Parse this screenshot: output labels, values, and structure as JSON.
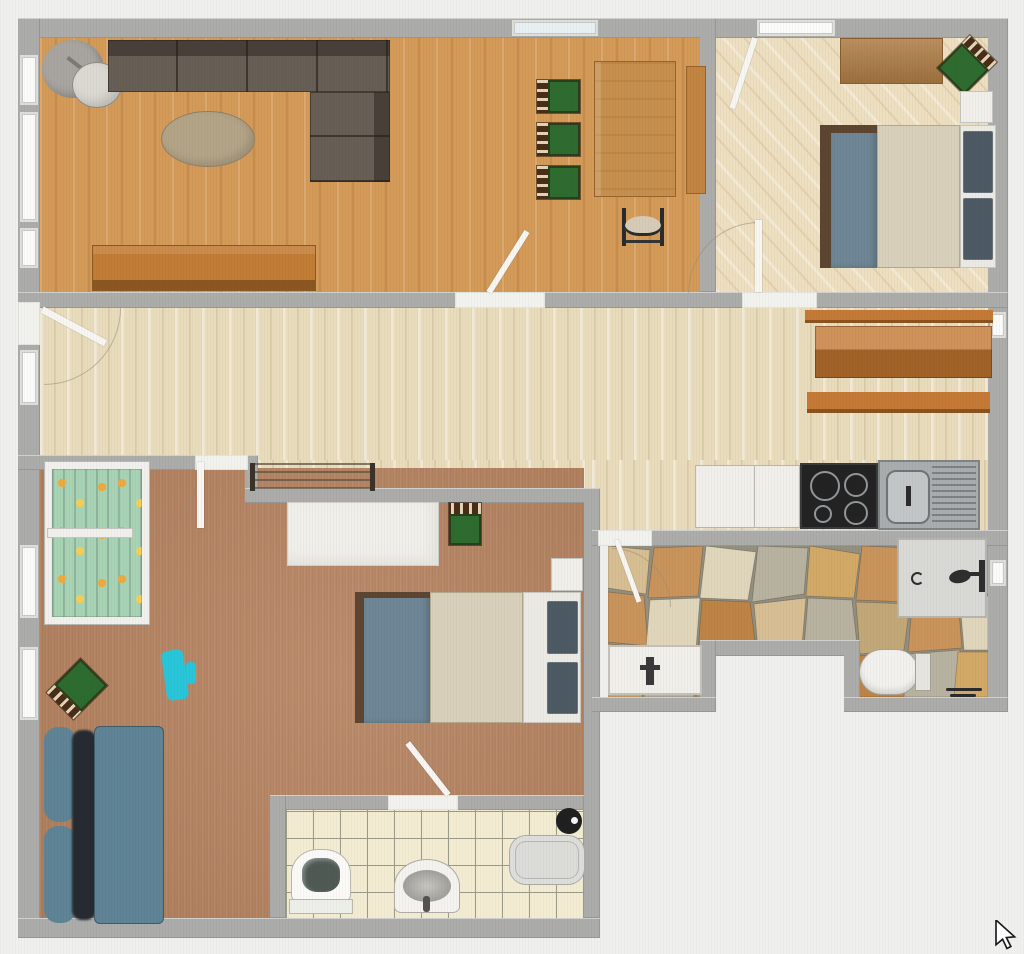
{
  "view": {
    "type": "floor-plan-2d-top-view",
    "cursor_glyph": "arrow-pointer"
  },
  "palette": {
    "wall": "#ACACAA",
    "threshold": "#F2F2EF",
    "window": "#FBFBFA",
    "outside": "#F0F0EE",
    "floor_living": "#D49A58",
    "floor_bedroom": "#EDDFC0",
    "floor_hall": "#E9DCBC",
    "floor_kids": "#B5825F",
    "floor_tile": "#F3ECD2",
    "grout_stone": "#93907F",
    "sofa_dark": "#675E55",
    "sofa_dark_back": "#4E463F",
    "sofa_teal": "#5E8495",
    "sofa_teal_shadow": "#252B31",
    "coffee_table": "#B4A487",
    "sideboard": "#C17C35",
    "dining_table": "#C68F4E",
    "bench": "#C28441",
    "plank": "#C47A36",
    "chair_green": "#2E6B2F",
    "chair_frame": "#4A2D17",
    "chair_dark_seat": "#D6CBB6",
    "wardrobe": "#B08049",
    "bed_frame": "#5C4632",
    "bed_blanket": "#6E8695",
    "bed_mattress": "#D9D0BC",
    "bed_head": "#ECEAE5",
    "bed_pillow": "#4D5A64",
    "white_furniture": "#F0EFEA",
    "crib_blanket": "#A8D3B4",
    "toy": "#29C5D8",
    "radiator": "#5F5544",
    "cooktop": "#232323",
    "steel": "#A9ADAE",
    "shower": "#D9D9D5",
    "tub": "#DCDCD8",
    "fixture_dark": "#202020",
    "lamp_base": "#A8A5A0",
    "lamp_shade": "#DCD8D2"
  },
  "rooms": [
    {
      "id": "living-dining",
      "label": "living-dining-room",
      "floor": "orange wood planks"
    },
    {
      "id": "bedroom-main",
      "label": "main-bedroom",
      "floor": "light wood diagonal"
    },
    {
      "id": "hallway-kitchen",
      "label": "hallway-with-kitchenette",
      "floor": "pale birch planks"
    },
    {
      "id": "kids-room",
      "label": "kids-bedroom",
      "floor": "terracotta carpet"
    },
    {
      "id": "bathroom",
      "label": "bathroom",
      "floor": "cream tiles with grid"
    },
    {
      "id": "shower-room",
      "label": "shower-room",
      "floor": "flagstone"
    }
  ],
  "furniture": {
    "living_dining": [
      "floor-lamp",
      "sectional-sofa",
      "coffee-table",
      "sideboard",
      "dining-table",
      "dining-chair x3",
      "side-bench",
      "dark-chair"
    ],
    "bedroom_main": [
      "wardrobe",
      "corner-chair",
      "nightstand",
      "double-bed"
    ],
    "hallway": [
      "radiator",
      "wall-plank x3",
      "kitchen-counter",
      "cooktop",
      "kitchen-sink"
    ],
    "kids_room": [
      "crib",
      "desk",
      "desk-chair",
      "double-bed",
      "nightstand",
      "toy",
      "corner-chair",
      "loveseat"
    ],
    "bathroom": [
      "toilet",
      "washbasin",
      "bathtub",
      "dark-fixture"
    ],
    "shower_room": [
      "vanity-basin",
      "shower-stall",
      "toilet",
      "floor-fixture"
    ]
  },
  "doors": [
    "entry-door",
    "living-hall-door",
    "bedroom-door",
    "balcony-door",
    "kids-room-door",
    "bathroom-door",
    "shower-room-door"
  ],
  "cursor": {
    "glyph": "arrow",
    "x": 998,
    "y": 925
  }
}
